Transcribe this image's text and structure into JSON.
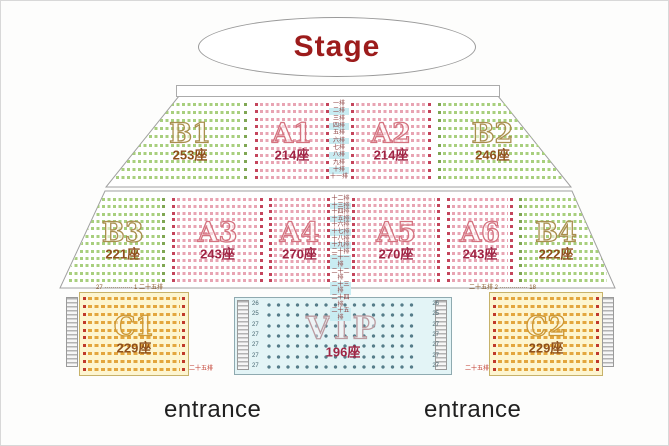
{
  "stage": {
    "label": "Stage"
  },
  "entrances": {
    "left": "entrance",
    "right": "entrance"
  },
  "sections": [
    {
      "id": "B1",
      "name": "B1",
      "seats": "253座",
      "family": "green",
      "rows": 10
    },
    {
      "id": "A1",
      "name": "A1",
      "seats": "214座",
      "family": "pink",
      "rows": 11
    },
    {
      "id": "A2",
      "name": "A2",
      "seats": "214座",
      "family": "pink",
      "rows": 11
    },
    {
      "id": "B2",
      "name": "B2",
      "seats": "246座",
      "family": "green",
      "rows": 10
    },
    {
      "id": "B3",
      "name": "B3",
      "seats": "221座",
      "family": "green",
      "rows": 12
    },
    {
      "id": "A3",
      "name": "A3",
      "seats": "243座",
      "family": "pink",
      "rows": 13
    },
    {
      "id": "A4",
      "name": "A4",
      "seats": "270座",
      "family": "pink",
      "rows": 14
    },
    {
      "id": "A5",
      "name": "A5",
      "seats": "270座",
      "family": "pink",
      "rows": 14
    },
    {
      "id": "A6",
      "name": "A6",
      "seats": "243座",
      "family": "pink",
      "rows": 13
    },
    {
      "id": "B4",
      "name": "B4",
      "seats": "222座",
      "family": "green",
      "rows": 12
    },
    {
      "id": "C1",
      "name": "C1",
      "seats": "229座",
      "family": "yellow",
      "rows": 10
    },
    {
      "id": "VIP",
      "name": "VIP",
      "seats": "196座",
      "family": "vip",
      "rows": 7
    },
    {
      "id": "C2",
      "name": "C2",
      "seats": "229座",
      "family": "yellow",
      "rows": 10
    }
  ],
  "row_labels_upper": [
    "一排",
    "二排",
    "三排",
    "四排",
    "五排",
    "六排",
    "七排",
    "八排",
    "九排",
    "十排",
    "十一排"
  ],
  "row_labels_middle": [
    "十二排",
    "十三排",
    "十四排",
    "十五排",
    "十六排",
    "十七排",
    "十八排",
    "十九排",
    "二十排",
    "二十一排",
    "二十二排",
    "二十三排",
    "二十四排",
    "二十五排"
  ],
  "vip_row_numbers_left": [
    "26",
    "25",
    "27",
    "27",
    "27",
    "27",
    "27"
  ],
  "vip_row_numbers_right": [
    "26",
    "25",
    "27",
    "27",
    "27",
    "27",
    "27"
  ],
  "annotations": {
    "c1_top": "27 ·············· 1  二十五排",
    "c1_bottom": "二十五排",
    "c2_top": "二十五排  2 ·············· 18",
    "c2_bottom": "二十五排"
  },
  "colors": {
    "stage_text": "#9c1c1c",
    "green_seats": "#a8cf7e",
    "pink_seats": "#e8a4b3",
    "yellow_seats": "#e3a63e",
    "vip_seats": "#567d8a",
    "b_section_count": "#8f4f1a",
    "a_section_count": "#a02444",
    "entrance_text": "#1f1f1f"
  }
}
